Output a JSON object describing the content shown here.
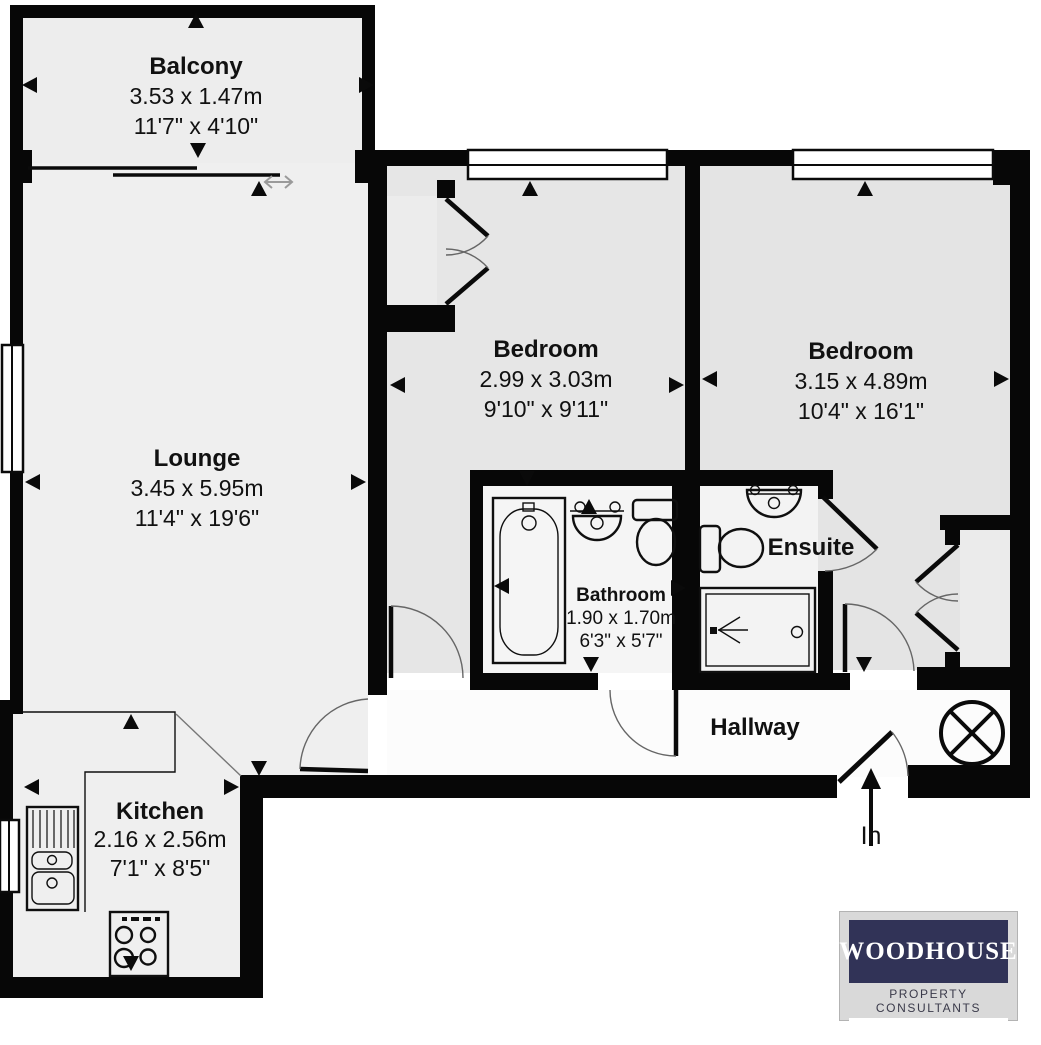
{
  "rooms": {
    "balcony": {
      "name": "Balcony",
      "metric": "3.53 x 1.47m",
      "imperial": "11'7\" x 4'10\""
    },
    "lounge": {
      "name": "Lounge",
      "metric": "3.45 x 5.95m",
      "imperial": "11'4\" x 19'6\""
    },
    "bedroom1": {
      "name": "Bedroom",
      "metric": "2.99 x 3.03m",
      "imperial": "9'10\" x 9'11\""
    },
    "bedroom2": {
      "name": "Bedroom",
      "metric": "3.15 x 4.89m",
      "imperial": "10'4\" x 16'1\""
    },
    "bathroom": {
      "name": "Bathroom",
      "metric": "1.90 x 1.70m",
      "imperial": "6'3\" x 5'7\""
    },
    "ensuite": {
      "name": "Ensuite"
    },
    "hallway": {
      "name": "Hallway"
    },
    "kitchen": {
      "name": "Kitchen",
      "metric": "2.16 x 2.56m",
      "imperial": "7'1\" x 8'5\""
    }
  },
  "entrance": {
    "label": "In"
  },
  "branding": {
    "brand": "WOODHOUSE",
    "tagline": "PROPERTY CONSULTANTS",
    "navy": "#313357"
  },
  "colors": {
    "wall": "#070707",
    "lounge_floor": "#efefef",
    "bedroom_floor": "#e4e4e4",
    "bathroom_floor": "#f5f5f5",
    "hallway_floor": "#fcfcfc"
  }
}
